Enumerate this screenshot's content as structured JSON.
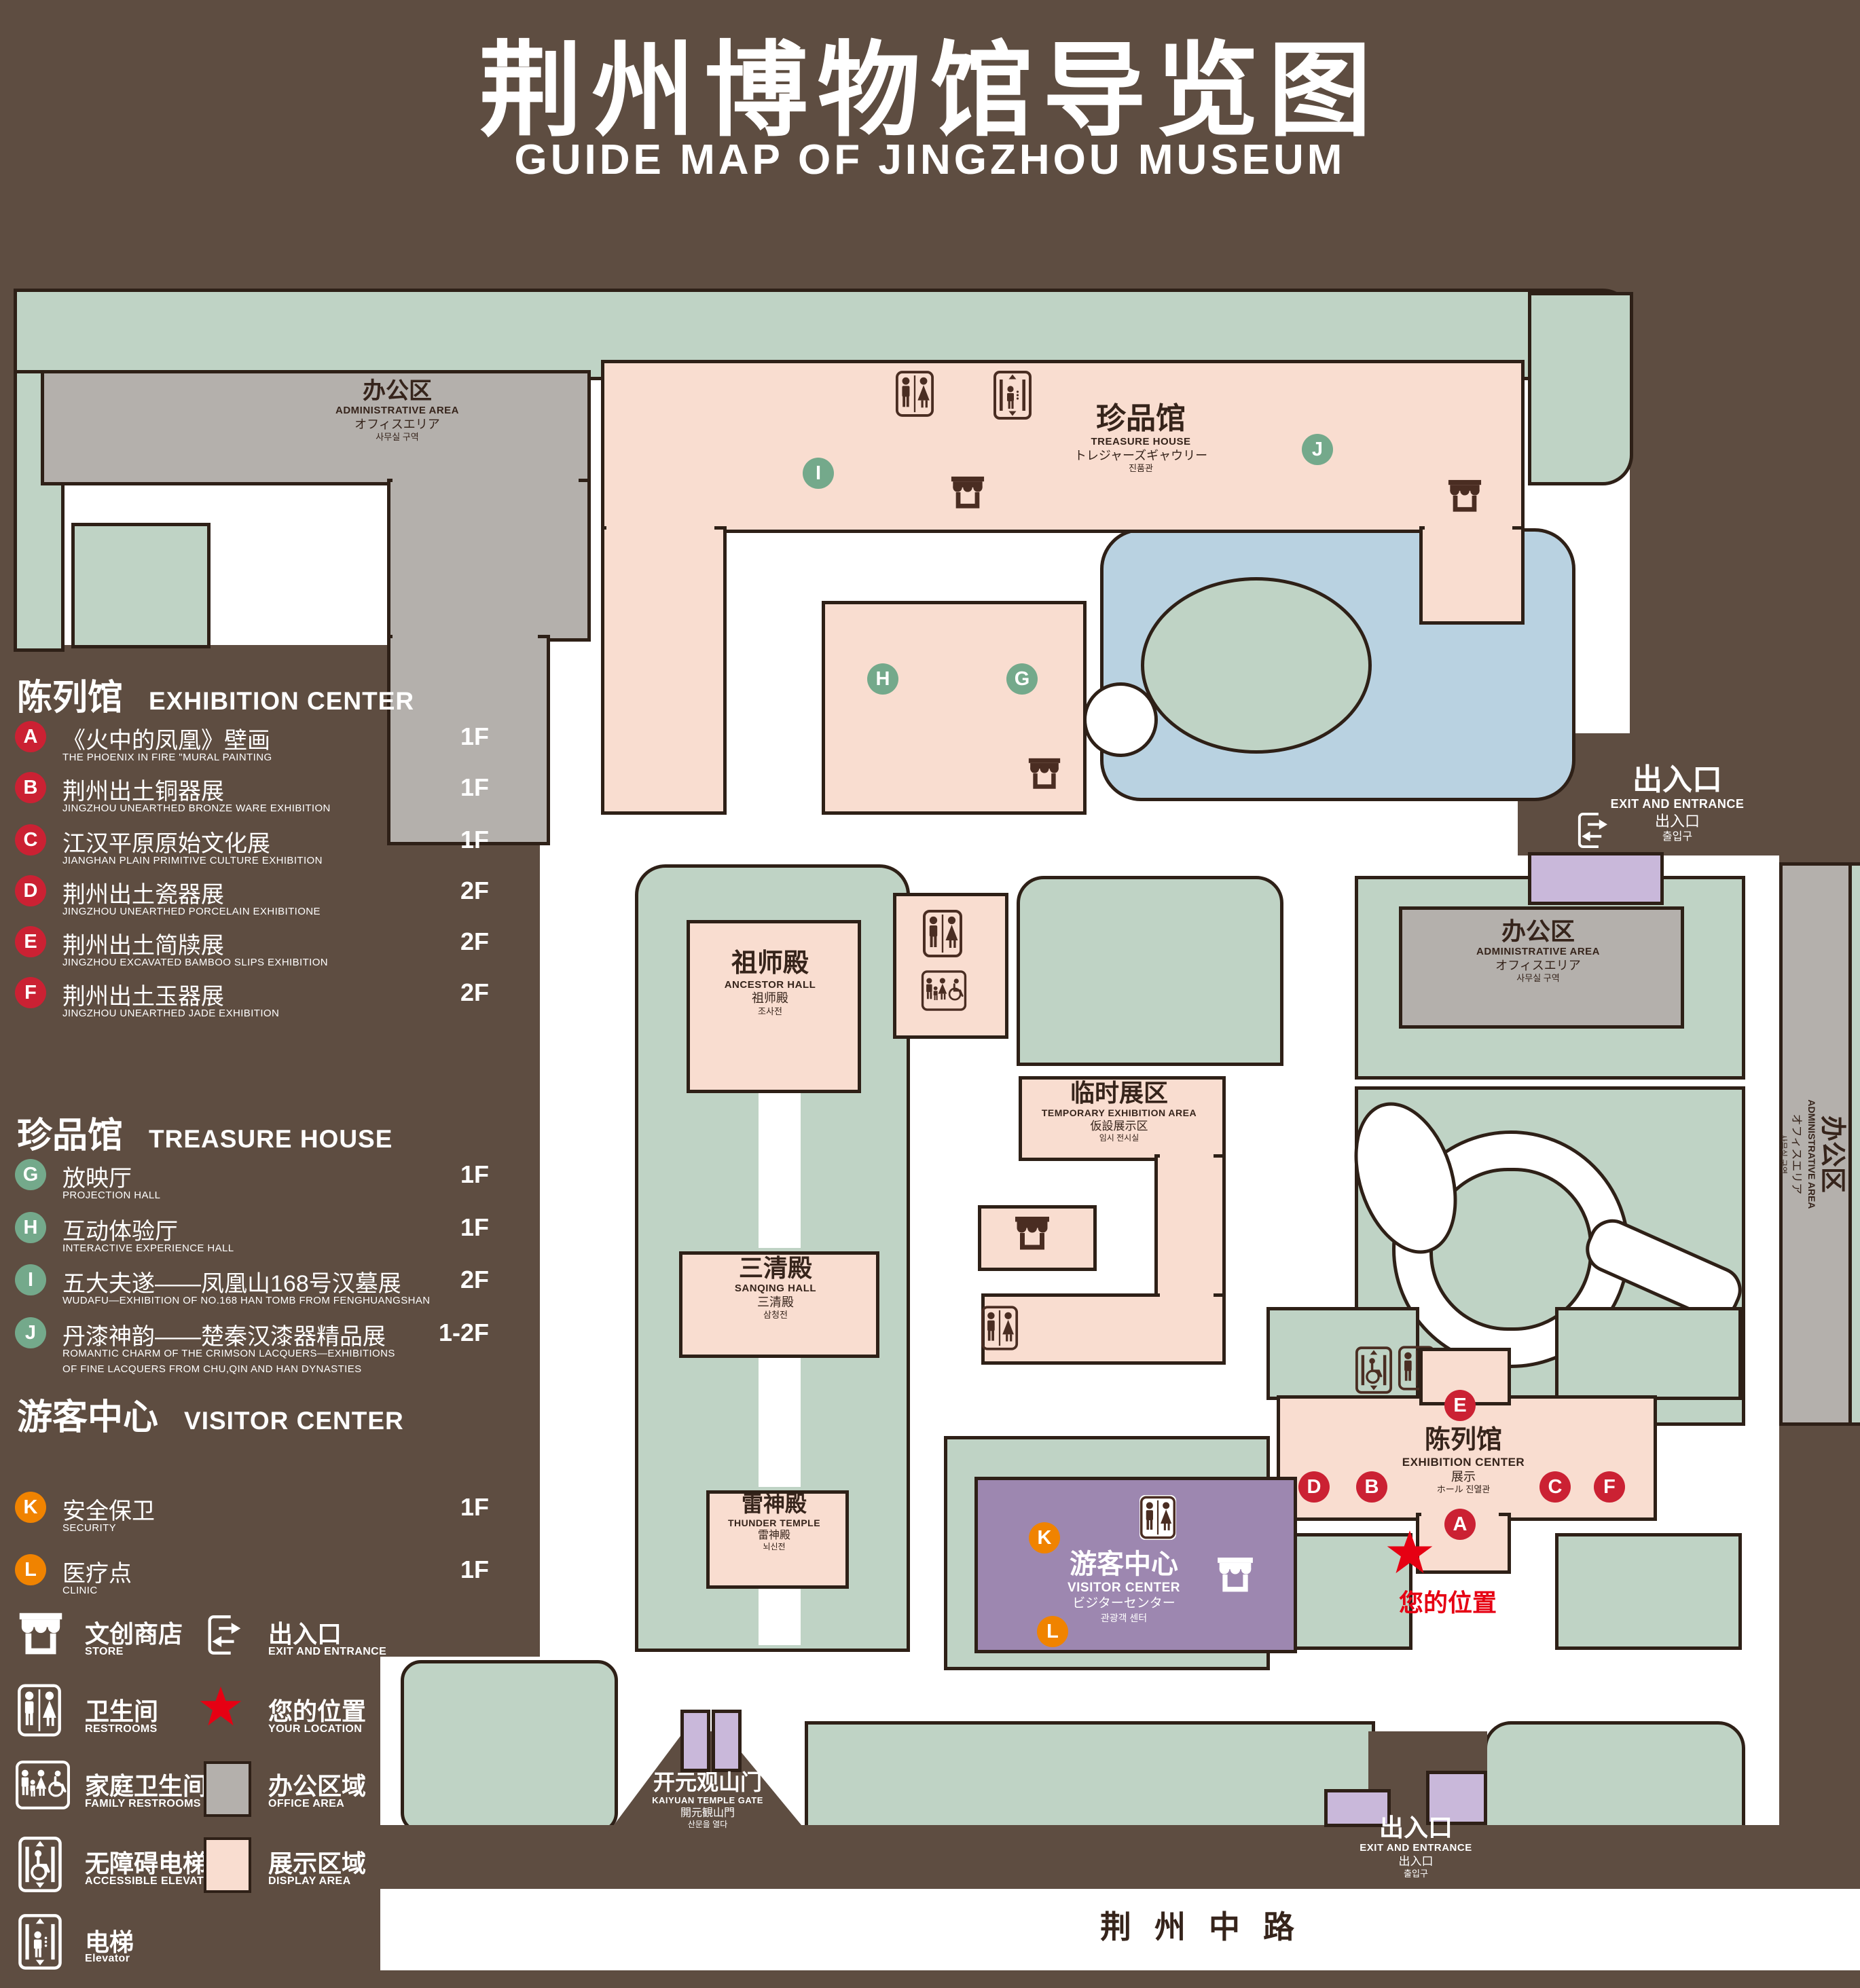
{
  "title": {
    "zh": "荆州博物馆导览图",
    "en": "GUIDE MAP OF JINGZHOU MUSEUM"
  },
  "colors": {
    "background": "#5e4d41",
    "outline": "#2e2017",
    "green_area": "#bfd3c5",
    "display_area": "#f9ddd0",
    "office_area": "#b4b0ac",
    "visitor_center": "#9d87b0",
    "small_buildings": "#c9b8da",
    "pond": "#b9d2e1",
    "marker_red": "#cb2133",
    "marker_green": "#74a98b",
    "marker_orange": "#f08300",
    "star_red": "#e60013"
  },
  "legend": {
    "sections": [
      {
        "zh": "陈列馆",
        "en": "EXHIBITION CENTER",
        "items": [
          {
            "letter": "A",
            "zh": "《火中的凤凰》壁画",
            "en": "THE PHOENIX IN FIRE \"MURAL PAINTING",
            "floor": "1F"
          },
          {
            "letter": "B",
            "zh": "荆州出土铜器展",
            "en": "JINGZHOU UNEARTHED BRONZE WARE EXHIBITION",
            "floor": "1F"
          },
          {
            "letter": "C",
            "zh": "江汉平原原始文化展",
            "en": "JIANGHAN PLAIN PRIMITIVE CULTURE EXHIBITION",
            "floor": "1F"
          },
          {
            "letter": "D",
            "zh": "荆州出土瓷器展",
            "en": "JINGZHOU UNEARTHED PORCELAIN EXHIBITIONE",
            "floor": "2F"
          },
          {
            "letter": "E",
            "zh": "荆州出土简牍展",
            "en": "JINGZHOU EXCAVATED BAMBOO SLIPS EXHIBITION",
            "floor": "2F"
          },
          {
            "letter": "F",
            "zh": "荆州出土玉器展",
            "en": "JINGZHOU UNEARTHED JADE EXHIBITION",
            "floor": "2F"
          }
        ]
      },
      {
        "zh": "珍品馆",
        "en": "TREASURE HOUSE",
        "items": [
          {
            "letter": "G",
            "zh": "放映厅",
            "en": "PROJECTION HALL",
            "floor": "1F"
          },
          {
            "letter": "H",
            "zh": "互动体验厅",
            "en": "INTERACTIVE EXPERIENCE HALL",
            "floor": "1F"
          },
          {
            "letter": "I",
            "zh": "五大夫遂——凤凰山168号汉墓展",
            "en": "WUDAFU—EXHIBITION OF NO.168 HAN TOMB FROM FENGHUANGSHAN",
            "floor": "2F"
          },
          {
            "letter": "J",
            "zh": "丹漆神韵——楚秦汉漆器精品展",
            "en": "ROMANTIC CHARM OF THE CRIMSON LACQUERS—EXHIBITIONS",
            "en2": "OF FINE LACQUERS FROM CHU,QIN AND HAN DYNASTIES",
            "floor": "1-2F"
          }
        ]
      },
      {
        "zh": "游客中心",
        "en": "VISITOR CENTER",
        "items": [
          {
            "letter": "K",
            "zh": "安全保卫",
            "en": "SECURITY",
            "floor": "1F"
          },
          {
            "letter": "L",
            "zh": "医疗点",
            "en": "CLINIC",
            "floor": "1F"
          }
        ]
      }
    ],
    "symbols": [
      {
        "icon": "store-icon",
        "zh": "文创商店",
        "en": "STORE"
      },
      {
        "icon": "exit-icon",
        "zh": "出入口",
        "en": "EXIT AND ENTRANCE"
      },
      {
        "icon": "restrooms-icon",
        "zh": "卫生间",
        "en": "RESTROOMS"
      },
      {
        "icon": "your-location-star-icon",
        "zh": "您的位置",
        "en": "YOUR LOCATION"
      },
      {
        "icon": "family-restrooms-icon",
        "zh": "家庭卫生间",
        "en": "FAMILY RESTROOMS"
      },
      {
        "icon": "office-area-swatch",
        "zh": "办公区域",
        "en": "OFFICE AREA"
      },
      {
        "icon": "accessible-elevator-icon",
        "zh": "无障碍电梯",
        "en": "ACCESSIBLE ELEVATOR"
      },
      {
        "icon": "display-area-swatch",
        "zh": "展示区域",
        "en": "DISPLAY AREA"
      },
      {
        "icon": "elevator-icon",
        "zh": "电梯",
        "en": "Elevator"
      }
    ]
  },
  "map": {
    "buildings": {
      "admin_tl": {
        "zh": "办公区",
        "en": "ADMINISTRATIVE AREA",
        "ja": "オフィスエリア",
        "ko": "사무실 구역"
      },
      "admin_right": {
        "zh": "办公区",
        "en": "ADMINISTRATIVE AREA",
        "ja": "オフィスエリア",
        "ko": "사무실 구역"
      },
      "admin_strip": {
        "zh": "办公区",
        "en": "ADMINISTRATIVE AREA",
        "ja": "オフィスエリア",
        "ko": "사무실 구역"
      },
      "treasure": {
        "zh": "珍品馆",
        "en": "TREASURE HOUSE",
        "ja": "トレジャーズギャウリー",
        "ko": "진품관"
      },
      "ancestor": {
        "zh": "祖师殿",
        "en": "ANCESTOR HALL",
        "ja": "祖师殿",
        "ko": "조사전"
      },
      "sanqing": {
        "zh": "三清殿",
        "en": "SANQING HALL",
        "ja": "三清殿",
        "ko": "삼청전"
      },
      "thunder": {
        "zh": "雷神殿",
        "en": "THUNDER TEMPLE",
        "ja": "雷神殿",
        "ko": "뇌신전"
      },
      "temporary": {
        "zh": "临时展区",
        "en": "TEMPORARY EXHIBITION AREA",
        "ja": "仮設展示区",
        "ko": "임시 전시실"
      },
      "exhibition": {
        "zh": "陈列馆",
        "en": "EXHIBITION CENTER",
        "ja": "展示",
        "ko": "ホール 진열관"
      },
      "visitor": {
        "zh": "游客中心",
        "en": "VISITOR CENTER",
        "ja": "ビジターセンター",
        "ko": "관광객 센터"
      },
      "exit_mid": {
        "zh": "出入口",
        "en": "EXIT AND ENTRANCE",
        "ja": "出入口",
        "ko": "출입구"
      },
      "exit_bottom": {
        "zh": "出入口",
        "en": "EXIT AND ENTRANCE",
        "ja": "出入口",
        "ko": "출입구"
      },
      "gate": {
        "zh": "开元观山门",
        "en": "KAIYUAN TEMPLE GATE",
        "ja": "開元観山門",
        "ko": "산문을 열다"
      },
      "road": {
        "zh": "荆州中路"
      },
      "your_location": {
        "zh": "您的位置"
      }
    },
    "markers": {
      "a": "A",
      "b": "B",
      "c": "C",
      "d": "D",
      "e": "E",
      "f": "F",
      "g": "G",
      "h": "H",
      "i": "I",
      "j": "J",
      "k": "K",
      "l": "L"
    }
  }
}
